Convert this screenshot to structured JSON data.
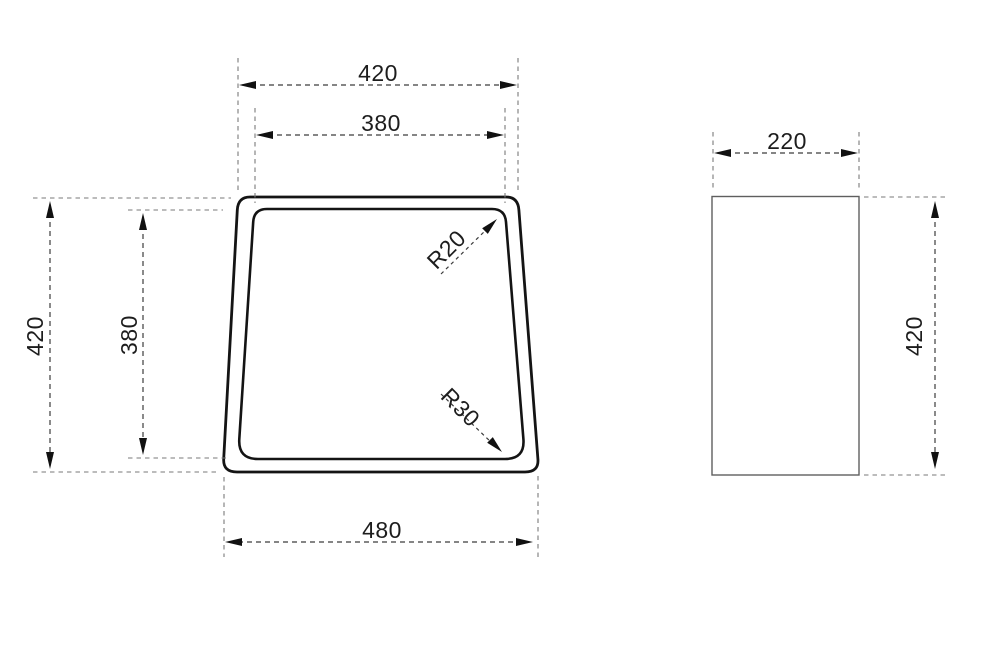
{
  "front_view": {
    "dim_width_top": "420",
    "dim_width_top_inner": "380",
    "dim_height_left": "420",
    "dim_height_left_inner": "380",
    "dim_width_bottom": "480",
    "radius_top": "R20",
    "radius_bottom": "R30"
  },
  "side_view": {
    "dim_width_top": "220",
    "dim_height_right": "420"
  },
  "style": {
    "outline_color": "#141414",
    "thin_line_color": "#5f5f5f",
    "dimension_line_color": "#3c3c3c",
    "extension_line_color": "#7a7a7a",
    "text_color": "#1d1d1d",
    "background": "#ffffff"
  }
}
